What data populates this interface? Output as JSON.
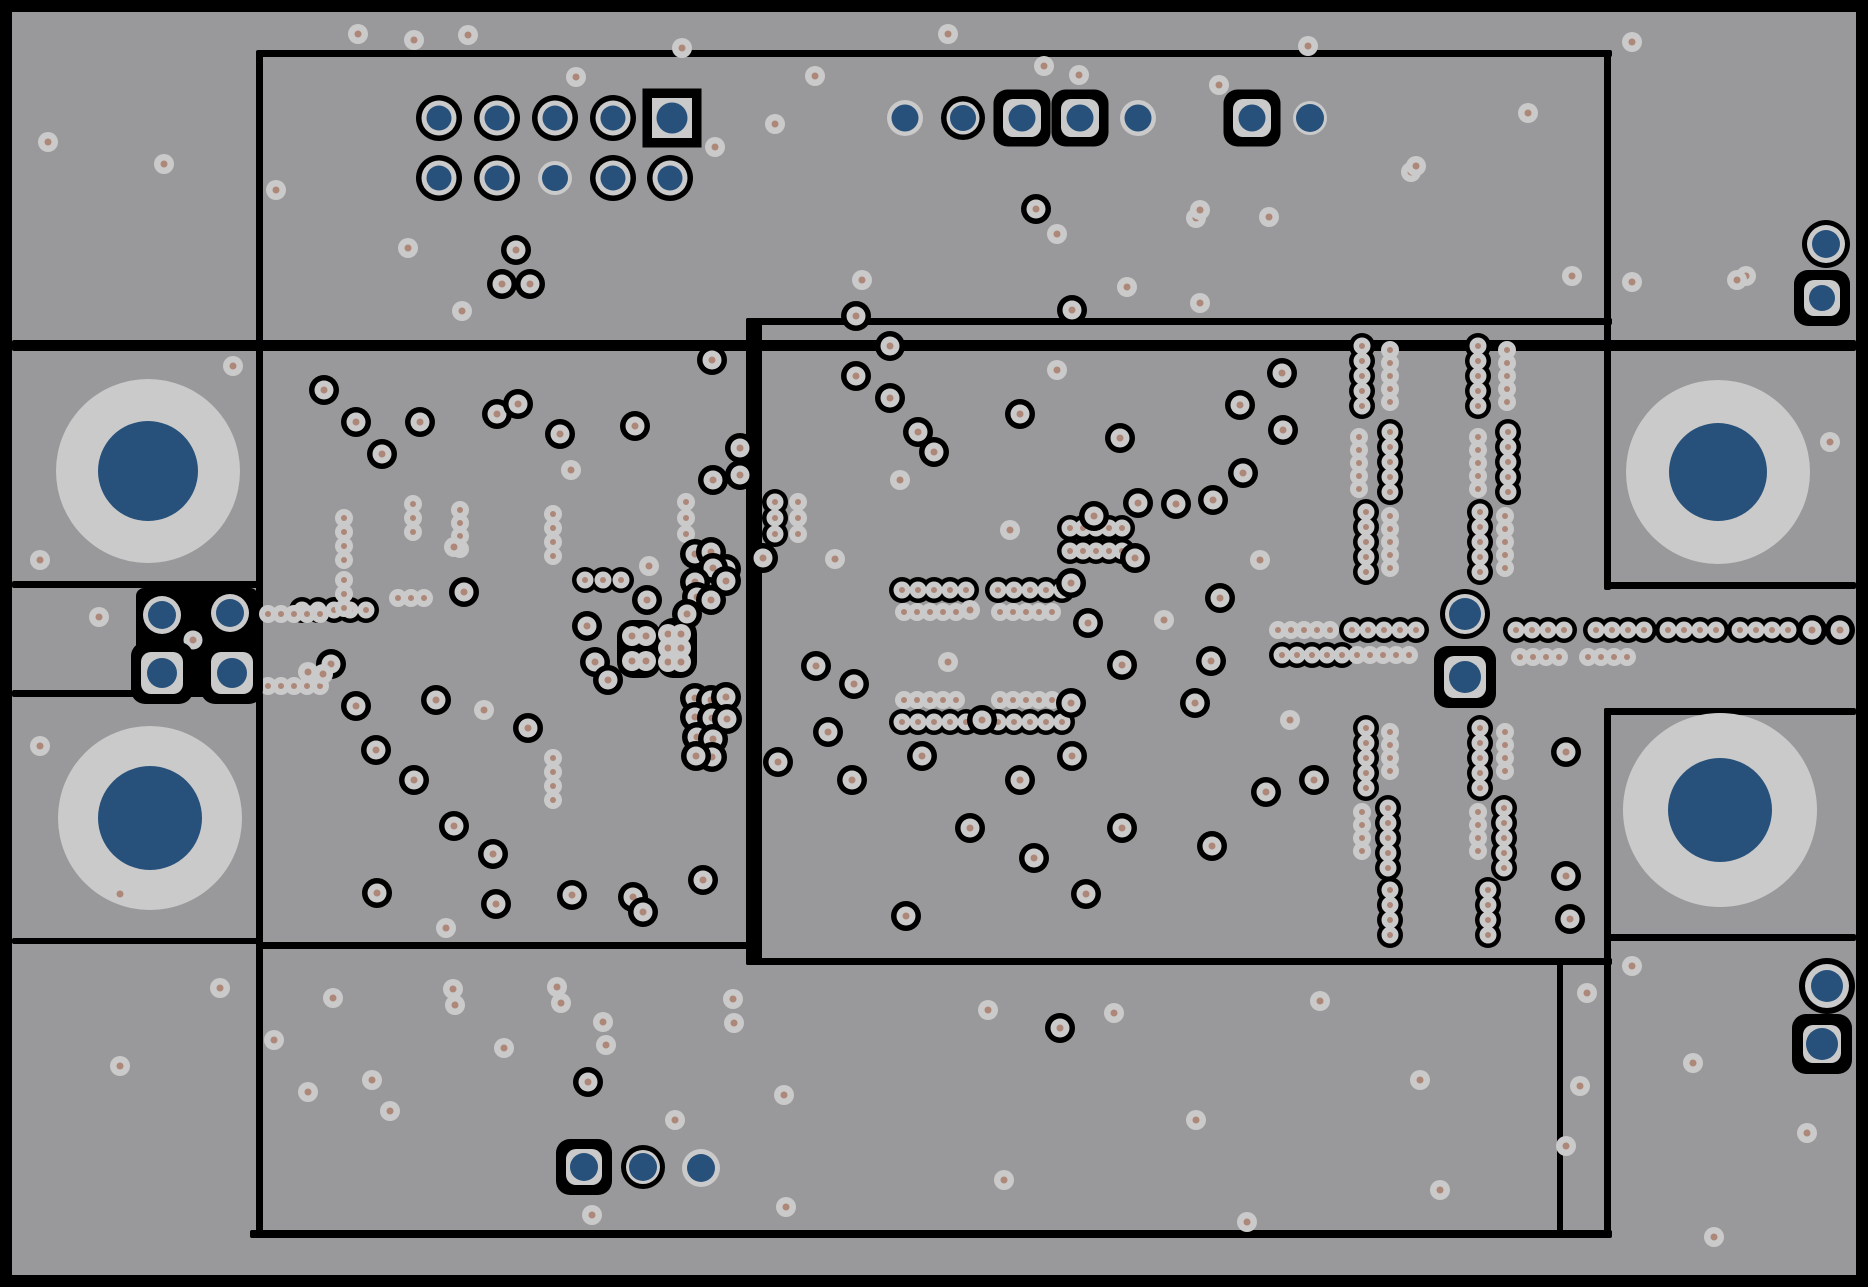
{
  "canvas": {
    "width": 1868,
    "height": 1287
  },
  "colors": {
    "background": "#000000",
    "board": "#99999b",
    "annulus": "#cacacb",
    "drill_dot": "#ad8778",
    "plated_blue": "#27517a",
    "keepout": "#000000"
  },
  "board": {
    "x": 12,
    "y": 12,
    "w": 1844,
    "h": 1263
  },
  "via_sizes": {
    "free": {
      "rg": 10,
      "dot": 3.5
    },
    "ringed": {
      "rb": 15,
      "rg": 9.5,
      "dot": 3.5
    },
    "chain_black": {
      "rb": 13,
      "rg": 8.5,
      "dot": 3
    },
    "chain_gray": {
      "rg": 9,
      "dot": 3
    }
  },
  "region_lines": [
    {
      "x": 258,
      "y": 50,
      "w": 1354,
      "h": 7
    },
    {
      "x": 256,
      "y": 50,
      "w": 7,
      "h": 1188
    },
    {
      "x": 12,
      "y": 340,
      "w": 1844,
      "h": 11
    },
    {
      "x": 1604,
      "y": 50,
      "w": 7,
      "h": 540
    },
    {
      "x": 1604,
      "y": 582,
      "w": 252,
      "h": 7
    },
    {
      "x": 1604,
      "y": 708,
      "w": 252,
      "h": 7
    },
    {
      "x": 1604,
      "y": 708,
      "w": 7,
      "h": 530
    },
    {
      "x": 1607,
      "y": 934,
      "w": 249,
      "h": 7
    },
    {
      "x": 12,
      "y": 581,
      "w": 246,
      "h": 7
    },
    {
      "x": 12,
      "y": 690,
      "w": 246,
      "h": 7
    },
    {
      "x": 12,
      "y": 938,
      "w": 246,
      "h": 6
    },
    {
      "x": 258,
      "y": 942,
      "w": 497,
      "h": 7
    },
    {
      "x": 746,
      "y": 318,
      "w": 16,
      "h": 647
    },
    {
      "x": 746,
      "y": 318,
      "w": 866,
      "h": 7
    },
    {
      "x": 746,
      "y": 958,
      "w": 866,
      "h": 7
    },
    {
      "x": 1557,
      "y": 958,
      "w": 6,
      "h": 276
    },
    {
      "x": 250,
      "y": 1230,
      "w": 1362,
      "h": 8
    }
  ],
  "keepout_blobs": [
    {
      "x": 136,
      "y": 588,
      "w": 122,
      "h": 107,
      "rx": 8
    },
    {
      "x": 617,
      "y": 620,
      "w": 44,
      "h": 58,
      "rx": 16
    },
    {
      "x": 657,
      "y": 618,
      "w": 40,
      "h": 60,
      "rx": 16
    }
  ],
  "mounting_holes": [
    {
      "x": 148,
      "y": 471,
      "r_outer": 92,
      "r_inner": 50
    },
    {
      "x": 150,
      "y": 818,
      "r_outer": 92,
      "r_inner": 52
    },
    {
      "x": 1718,
      "y": 472,
      "r_outer": 92,
      "r_inner": 49
    },
    {
      "x": 1720,
      "y": 810,
      "r_outer": 97,
      "r_inner": 52
    }
  ],
  "pads": [
    {
      "type": "ring",
      "x": 439,
      "y": 118,
      "rb": 23,
      "rg": 17.5,
      "rc": 12.5
    },
    {
      "type": "ring",
      "x": 497,
      "y": 118,
      "rb": 23,
      "rg": 17.5,
      "rc": 12.5
    },
    {
      "type": "ring",
      "x": 555,
      "y": 118,
      "rb": 23,
      "rg": 17.5,
      "rc": 12.5
    },
    {
      "type": "ring",
      "x": 613,
      "y": 118,
      "rb": 23,
      "rg": 17.5,
      "rc": 12.5
    },
    {
      "type": "square",
      "x": 672,
      "y": 118,
      "s": 49,
      "sg": 40,
      "rc": 15.5
    },
    {
      "type": "ring",
      "x": 439,
      "y": 178,
      "rb": 23,
      "rg": 17.5,
      "rc": 12.5
    },
    {
      "type": "ring",
      "x": 497,
      "y": 178,
      "rb": 23,
      "rg": 17.5,
      "rc": 12.5
    },
    {
      "type": "plain",
      "x": 555,
      "y": 178,
      "rg": 17,
      "rc": 13
    },
    {
      "type": "ring",
      "x": 613,
      "y": 178,
      "rb": 23,
      "rg": 17.5,
      "rc": 12.5
    },
    {
      "type": "ring",
      "x": 670,
      "y": 178,
      "rb": 23,
      "rg": 17.5,
      "rc": 12.5
    },
    {
      "type": "plain",
      "x": 905,
      "y": 118,
      "rg": 18,
      "rc": 13.5
    },
    {
      "type": "ring",
      "x": 963,
      "y": 118,
      "rb": 22,
      "rg": 16.5,
      "rc": 13
    },
    {
      "type": "rsq",
      "x": 1022,
      "y": 118,
      "s": 47,
      "sg": 38,
      "rc": 13.5
    },
    {
      "type": "rsq",
      "x": 1080,
      "y": 118,
      "s": 47,
      "sg": 38,
      "rc": 13.5
    },
    {
      "type": "plain",
      "x": 1138,
      "y": 118,
      "rg": 18,
      "rc": 13.5
    },
    {
      "type": "rsq",
      "x": 1252,
      "y": 118,
      "s": 47,
      "sg": 38,
      "rc": 13.5
    },
    {
      "type": "plain",
      "x": 1310,
      "y": 118,
      "rg": 17,
      "rc": 14
    },
    {
      "type": "ring",
      "x": 162,
      "y": 615,
      "rb": 24,
      "rg": 19,
      "rc": 14
    },
    {
      "type": "ring",
      "x": 230,
      "y": 613,
      "rb": 24,
      "rg": 19,
      "rc": 14
    },
    {
      "type": "rsq",
      "x": 162,
      "y": 673,
      "s": 52,
      "sg": 42,
      "rc": 15
    },
    {
      "type": "rsq",
      "x": 232,
      "y": 673,
      "s": 52,
      "sg": 42,
      "rc": 15
    },
    {
      "type": "ring",
      "x": 1465,
      "y": 614,
      "rb": 25,
      "rg": 20,
      "rc": 16
    },
    {
      "type": "rsq",
      "x": 1465,
      "y": 677,
      "s": 52,
      "sg": 42,
      "rc": 16
    },
    {
      "type": "ring",
      "x": 1826,
      "y": 244,
      "rb": 24,
      "rg": 19,
      "rc": 14
    },
    {
      "type": "rsq",
      "x": 1822,
      "y": 298,
      "s": 46,
      "sg": 36,
      "rc": 13
    },
    {
      "type": "ring",
      "x": 1827,
      "y": 986,
      "rb": 28,
      "rg": 22,
      "rc": 16
    },
    {
      "type": "rsq",
      "x": 1822,
      "y": 1044,
      "s": 50,
      "sg": 38,
      "rc": 16
    },
    {
      "type": "rsq",
      "x": 584,
      "y": 1167,
      "s": 46,
      "sg": 36,
      "rc": 14
    },
    {
      "type": "ring",
      "x": 643,
      "y": 1167,
      "rb": 22,
      "rg": 17,
      "rc": 14
    },
    {
      "type": "plain",
      "x": 701,
      "y": 1168,
      "rg": 19,
      "rc": 14
    }
  ],
  "via_chains": [
    {
      "style": "black",
      "x": 302,
      "y": 610,
      "n": 5,
      "dx": 16,
      "dy": 0
    },
    {
      "style": "black",
      "x": 585,
      "y": 580,
      "n": 3,
      "dx": 18,
      "dy": 0
    },
    {
      "style": "black",
      "x": 775,
      "y": 502,
      "n": 3,
      "dx": 0,
      "dy": 16
    },
    {
      "style": "black",
      "x": 902,
      "y": 590,
      "n": 5,
      "dx": 16,
      "dy": 0
    },
    {
      "style": "black",
      "x": 998,
      "y": 590,
      "n": 5,
      "dx": 16,
      "dy": 0
    },
    {
      "style": "black",
      "x": 902,
      "y": 722,
      "n": 5,
      "dx": 16,
      "dy": 0
    },
    {
      "style": "black",
      "x": 998,
      "y": 722,
      "n": 5,
      "dx": 16,
      "dy": 0
    },
    {
      "style": "black",
      "x": 1070,
      "y": 528,
      "n": 5,
      "dx": 13,
      "dy": 0
    },
    {
      "style": "black",
      "x": 1070,
      "y": 551,
      "n": 5,
      "dx": 13,
      "dy": 0
    },
    {
      "style": "black",
      "x": 1362,
      "y": 346,
      "n": 5,
      "dx": 0,
      "dy": 15
    },
    {
      "style": "black",
      "x": 1478,
      "y": 346,
      "n": 5,
      "dx": 0,
      "dy": 15
    },
    {
      "style": "black",
      "x": 1390,
      "y": 432,
      "n": 5,
      "dx": 0,
      "dy": 15
    },
    {
      "style": "black",
      "x": 1508,
      "y": 432,
      "n": 5,
      "dx": 0,
      "dy": 15
    },
    {
      "style": "black",
      "x": 1366,
      "y": 512,
      "n": 5,
      "dx": 0,
      "dy": 15
    },
    {
      "style": "black",
      "x": 1480,
      "y": 512,
      "n": 5,
      "dx": 0,
      "dy": 15
    },
    {
      "style": "black",
      "x": 1352,
      "y": 630,
      "n": 5,
      "dx": 16,
      "dy": 0
    },
    {
      "style": "black",
      "x": 1516,
      "y": 630,
      "n": 4,
      "dx": 16,
      "dy": 0
    },
    {
      "style": "black",
      "x": 1596,
      "y": 630,
      "n": 4,
      "dx": 16,
      "dy": 0
    },
    {
      "style": "black",
      "x": 1668,
      "y": 630,
      "n": 4,
      "dx": 16,
      "dy": 0
    },
    {
      "style": "black",
      "x": 1740,
      "y": 630,
      "n": 4,
      "dx": 16,
      "dy": 0
    },
    {
      "style": "black",
      "x": 1282,
      "y": 655,
      "n": 5,
      "dx": 15,
      "dy": 0
    },
    {
      "style": "black",
      "x": 1366,
      "y": 728,
      "n": 5,
      "dx": 0,
      "dy": 15
    },
    {
      "style": "black",
      "x": 1480,
      "y": 728,
      "n": 5,
      "dx": 0,
      "dy": 15
    },
    {
      "style": "black",
      "x": 1388,
      "y": 808,
      "n": 5,
      "dx": 0,
      "dy": 15
    },
    {
      "style": "black",
      "x": 1504,
      "y": 808,
      "n": 5,
      "dx": 0,
      "dy": 15
    },
    {
      "style": "black",
      "x": 1390,
      "y": 890,
      "n": 4,
      "dx": 0,
      "dy": 15
    },
    {
      "style": "black",
      "x": 1488,
      "y": 890,
      "n": 4,
      "dx": 0,
      "dy": 15
    },
    {
      "style": "gray",
      "x": 344,
      "y": 518,
      "n": 4,
      "dx": 0,
      "dy": 14
    },
    {
      "style": "gray",
      "x": 344,
      "y": 580,
      "n": 3,
      "dx": 0,
      "dy": 14
    },
    {
      "style": "gray",
      "x": 413,
      "y": 504,
      "n": 3,
      "dx": 0,
      "dy": 14
    },
    {
      "style": "gray",
      "x": 460,
      "y": 510,
      "n": 4,
      "dx": 0,
      "dy": 13
    },
    {
      "style": "gray",
      "x": 553,
      "y": 514,
      "n": 4,
      "dx": 0,
      "dy": 14
    },
    {
      "style": "gray",
      "x": 553,
      "y": 758,
      "n": 4,
      "dx": 0,
      "dy": 14
    },
    {
      "style": "gray",
      "x": 268,
      "y": 614,
      "n": 5,
      "dx": 13,
      "dy": 0
    },
    {
      "style": "gray",
      "x": 268,
      "y": 686,
      "n": 5,
      "dx": 13,
      "dy": 0
    },
    {
      "style": "gray",
      "x": 398,
      "y": 598,
      "n": 3,
      "dx": 13,
      "dy": 0
    },
    {
      "style": "gray",
      "x": 686,
      "y": 502,
      "n": 3,
      "dx": 0,
      "dy": 16
    },
    {
      "style": "gray",
      "x": 798,
      "y": 502,
      "n": 3,
      "dx": 0,
      "dy": 16
    },
    {
      "style": "gray",
      "x": 904,
      "y": 612,
      "n": 5,
      "dx": 13,
      "dy": 0
    },
    {
      "style": "gray",
      "x": 1000,
      "y": 612,
      "n": 5,
      "dx": 13,
      "dy": 0
    },
    {
      "style": "gray",
      "x": 904,
      "y": 700,
      "n": 5,
      "dx": 13,
      "dy": 0
    },
    {
      "style": "gray",
      "x": 1000,
      "y": 700,
      "n": 5,
      "dx": 13,
      "dy": 0
    },
    {
      "style": "gray",
      "x": 1390,
      "y": 350,
      "n": 5,
      "dx": 0,
      "dy": 13
    },
    {
      "style": "gray",
      "x": 1507,
      "y": 350,
      "n": 5,
      "dx": 0,
      "dy": 13
    },
    {
      "style": "gray",
      "x": 1359,
      "y": 437,
      "n": 5,
      "dx": 0,
      "dy": 13
    },
    {
      "style": "gray",
      "x": 1478,
      "y": 437,
      "n": 5,
      "dx": 0,
      "dy": 13
    },
    {
      "style": "gray",
      "x": 1390,
      "y": 516,
      "n": 5,
      "dx": 0,
      "dy": 13
    },
    {
      "style": "gray",
      "x": 1505,
      "y": 516,
      "n": 5,
      "dx": 0,
      "dy": 13
    },
    {
      "style": "gray",
      "x": 1278,
      "y": 630,
      "n": 5,
      "dx": 13,
      "dy": 0
    },
    {
      "style": "gray",
      "x": 1357,
      "y": 655,
      "n": 5,
      "dx": 13,
      "dy": 0
    },
    {
      "style": "gray",
      "x": 1520,
      "y": 657,
      "n": 4,
      "dx": 13,
      "dy": 0
    },
    {
      "style": "gray",
      "x": 1588,
      "y": 657,
      "n": 4,
      "dx": 13,
      "dy": 0
    },
    {
      "style": "gray",
      "x": 1390,
      "y": 732,
      "n": 4,
      "dx": 0,
      "dy": 13
    },
    {
      "style": "gray",
      "x": 1505,
      "y": 732,
      "n": 4,
      "dx": 0,
      "dy": 13
    },
    {
      "style": "gray",
      "x": 1362,
      "y": 812,
      "n": 4,
      "dx": 0,
      "dy": 13
    },
    {
      "style": "gray",
      "x": 1478,
      "y": 812,
      "n": 4,
      "dx": 0,
      "dy": 13
    }
  ],
  "vias_ringed": [
    [
      1036,
      209
    ],
    [
      516,
      250
    ],
    [
      502,
      284
    ],
    [
      530,
      284
    ],
    [
      193,
      640
    ],
    [
      324,
      390
    ],
    [
      356,
      422
    ],
    [
      382,
      454
    ],
    [
      420,
      422
    ],
    [
      497,
      414
    ],
    [
      518,
      404
    ],
    [
      560,
      434
    ],
    [
      635,
      426
    ],
    [
      712,
      360
    ],
    [
      740,
      448
    ],
    [
      740,
      475
    ],
    [
      331,
      664
    ],
    [
      356,
      706
    ],
    [
      376,
      750
    ],
    [
      414,
      780
    ],
    [
      454,
      826
    ],
    [
      493,
      854
    ],
    [
      528,
      728
    ],
    [
      464,
      592
    ],
    [
      436,
      700
    ],
    [
      587,
      626
    ],
    [
      595,
      662
    ],
    [
      608,
      680
    ],
    [
      647,
      600
    ],
    [
      713,
      480
    ],
    [
      695,
      554
    ],
    [
      711,
      552
    ],
    [
      726,
      569
    ],
    [
      713,
      568
    ],
    [
      695,
      582
    ],
    [
      726,
      581
    ],
    [
      697,
      597
    ],
    [
      711,
      600
    ],
    [
      687,
      614
    ],
    [
      695,
      698
    ],
    [
      711,
      700
    ],
    [
      726,
      697
    ],
    [
      695,
      717
    ],
    [
      712,
      718
    ],
    [
      727,
      719
    ],
    [
      697,
      737
    ],
    [
      713,
      739
    ],
    [
      712,
      757
    ],
    [
      696,
      756
    ],
    [
      377,
      893
    ],
    [
      496,
      904
    ],
    [
      572,
      895
    ],
    [
      633,
      897
    ],
    [
      643,
      912
    ],
    [
      703,
      880
    ],
    [
      763,
      558
    ],
    [
      856,
      316
    ],
    [
      890,
      346
    ],
    [
      856,
      376
    ],
    [
      890,
      398
    ],
    [
      918,
      432
    ],
    [
      934,
      452
    ],
    [
      1020,
      414
    ],
    [
      1072,
      310
    ],
    [
      1094,
      516
    ],
    [
      1135,
      558
    ],
    [
      1176,
      504
    ],
    [
      1282,
      373
    ],
    [
      1240,
      405
    ],
    [
      1283,
      430
    ],
    [
      1243,
      473
    ],
    [
      1213,
      500
    ],
    [
      1138,
      503
    ],
    [
      1120,
      438
    ],
    [
      816,
      666
    ],
    [
      854,
      684
    ],
    [
      828,
      732
    ],
    [
      778,
      762
    ],
    [
      852,
      780
    ],
    [
      922,
      756
    ],
    [
      982,
      720
    ],
    [
      1020,
      780
    ],
    [
      1072,
      756
    ],
    [
      1122,
      828
    ],
    [
      970,
      828
    ],
    [
      1034,
      858
    ],
    [
      1086,
      894
    ],
    [
      1212,
      846
    ],
    [
      1266,
      792
    ],
    [
      906,
      916
    ],
    [
      1071,
      583
    ],
    [
      1088,
      623
    ],
    [
      1122,
      665
    ],
    [
      1071,
      703
    ],
    [
      1220,
      598
    ],
    [
      1211,
      661
    ],
    [
      1195,
      703
    ],
    [
      1812,
      630
    ],
    [
      1840,
      630
    ],
    [
      1566,
      752
    ],
    [
      1566,
      876
    ],
    [
      1314,
      780
    ],
    [
      1570,
      919
    ],
    [
      1060,
      1028
    ],
    [
      588,
      1082
    ]
  ],
  "vias_free": [
    [
      358,
      34
    ],
    [
      414,
      40
    ],
    [
      468,
      35
    ],
    [
      576,
      77
    ],
    [
      48,
      142
    ],
    [
      164,
      164
    ],
    [
      276,
      190
    ],
    [
      408,
      248
    ],
    [
      462,
      311
    ],
    [
      682,
      48
    ],
    [
      948,
      34
    ],
    [
      1308,
      46
    ],
    [
      1632,
      42
    ],
    [
      815,
      76
    ],
    [
      775,
      124
    ],
    [
      715,
      147
    ],
    [
      1044,
      66
    ],
    [
      1079,
      75
    ],
    [
      1219,
      85
    ],
    [
      1196,
      218
    ],
    [
      1269,
      217
    ],
    [
      1528,
      113
    ],
    [
      1411,
      172
    ],
    [
      1057,
      234
    ],
    [
      1200,
      210
    ],
    [
      1416,
      166
    ],
    [
      1572,
      276
    ],
    [
      1746,
      276
    ],
    [
      1127,
      287
    ],
    [
      1200,
      303
    ],
    [
      1632,
      282
    ],
    [
      1737,
      280
    ],
    [
      1830,
      442
    ],
    [
      233,
      366
    ],
    [
      40,
      560
    ],
    [
      99,
      617
    ],
    [
      120,
      894
    ],
    [
      40,
      746
    ],
    [
      308,
      672
    ],
    [
      323,
      674
    ],
    [
      484,
      710
    ],
    [
      649,
      566
    ],
    [
      454,
      547
    ],
    [
      571,
      470
    ],
    [
      446,
      928
    ],
    [
      632,
      636
    ],
    [
      646,
      636
    ],
    [
      632,
      661
    ],
    [
      646,
      661
    ],
    [
      668,
      634
    ],
    [
      681,
      634
    ],
    [
      668,
      648
    ],
    [
      681,
      648
    ],
    [
      668,
      662
    ],
    [
      681,
      662
    ],
    [
      835,
      559
    ],
    [
      862,
      280
    ],
    [
      1057,
      370
    ],
    [
      970,
      610
    ],
    [
      1164,
      620
    ],
    [
      1260,
      560
    ],
    [
      900,
      480
    ],
    [
      1010,
      530
    ],
    [
      948,
      662
    ],
    [
      1290,
      720
    ],
    [
      220,
      988
    ],
    [
      333,
      998
    ],
    [
      455,
      1005
    ],
    [
      561,
      1003
    ],
    [
      606,
      1045
    ],
    [
      733,
      999
    ],
    [
      308,
      1092
    ],
    [
      390,
      1111
    ],
    [
      453,
      989
    ],
    [
      557,
      987
    ],
    [
      603,
      1022
    ],
    [
      675,
      1120
    ],
    [
      784,
      1095
    ],
    [
      592,
      1215
    ],
    [
      786,
      1207
    ],
    [
      988,
      1010
    ],
    [
      1114,
      1013
    ],
    [
      1004,
      1180
    ],
    [
      1196,
      1120
    ],
    [
      1320,
      1001
    ],
    [
      1420,
      1080
    ],
    [
      1247,
      1222
    ],
    [
      1440,
      1190
    ],
    [
      734,
      1023
    ],
    [
      120,
      1066
    ],
    [
      274,
      1040
    ],
    [
      372,
      1080
    ],
    [
      504,
      1048
    ],
    [
      1632,
      966
    ],
    [
      1587,
      993
    ],
    [
      1693,
      1063
    ],
    [
      1580,
      1086
    ],
    [
      1807,
      1133
    ],
    [
      1566,
      1146
    ],
    [
      1714,
      1237
    ]
  ]
}
